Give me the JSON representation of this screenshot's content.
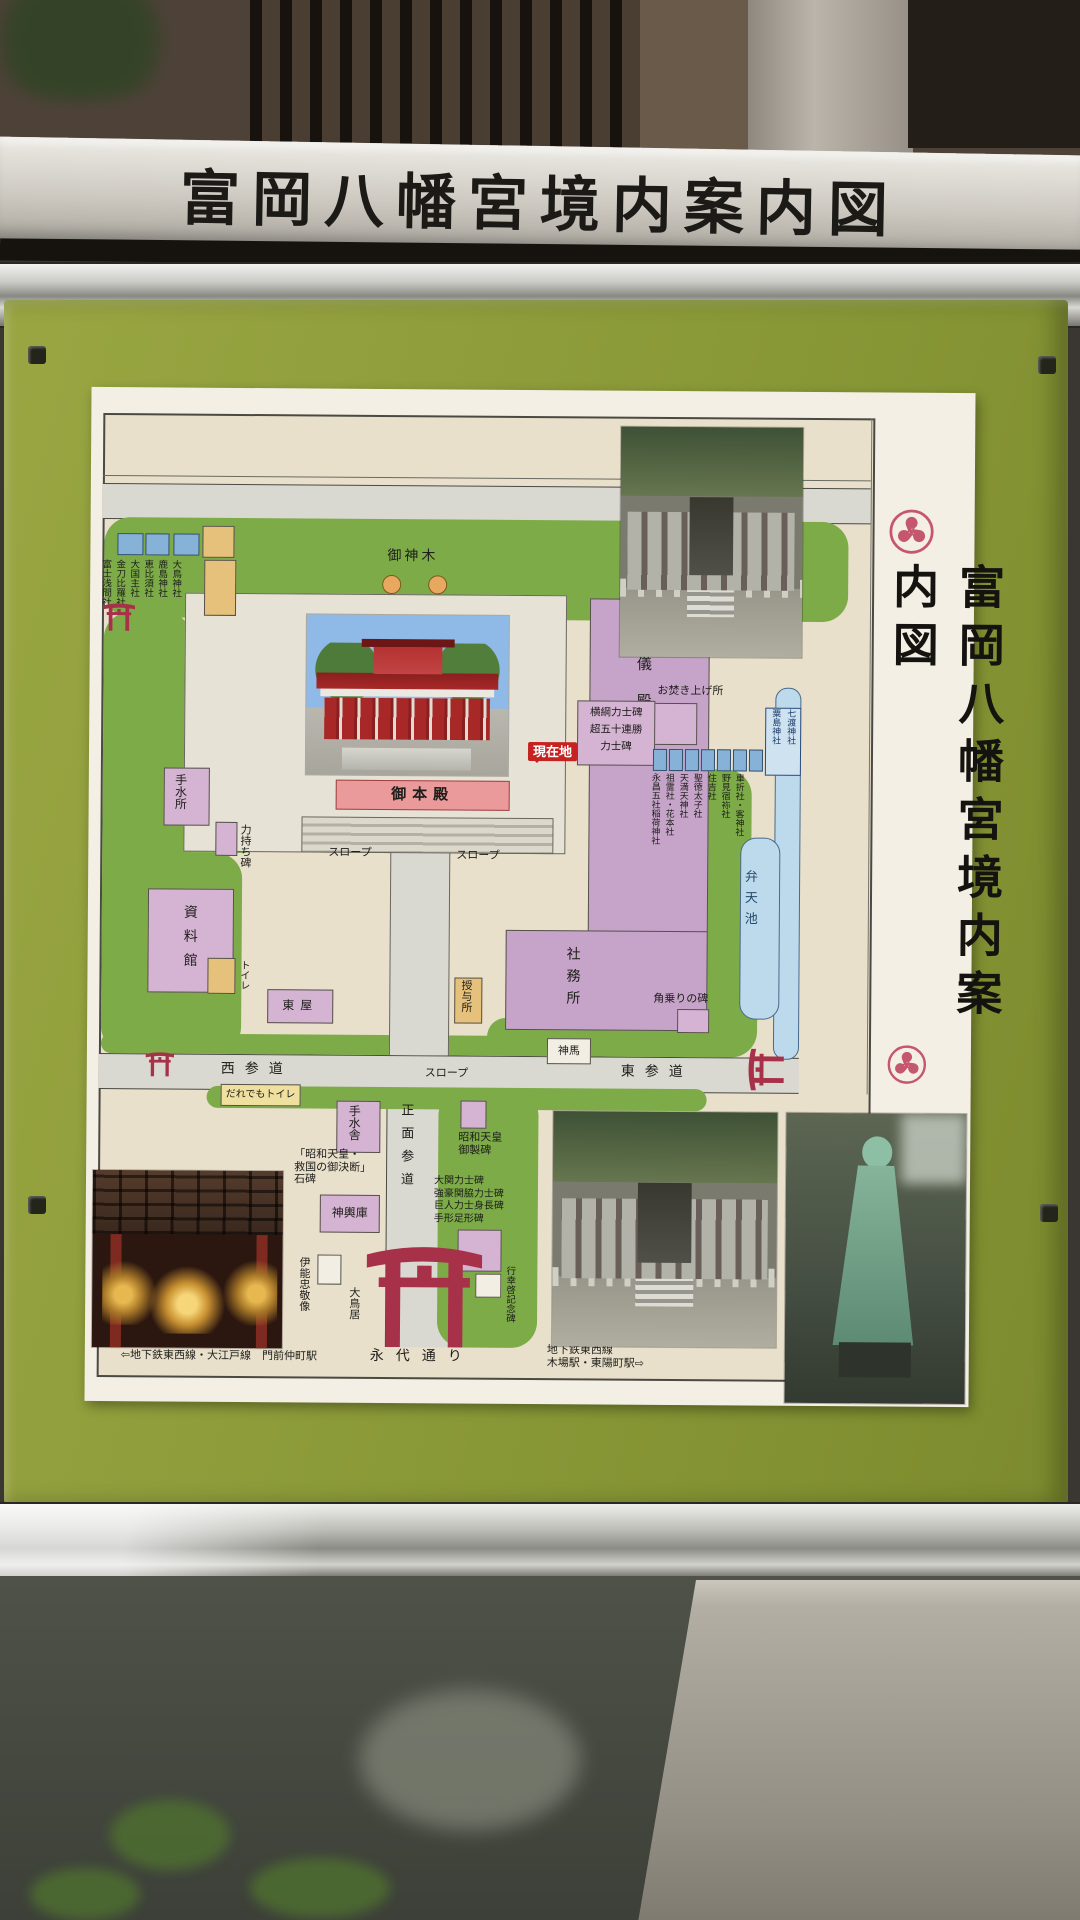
{
  "sign": {
    "header_title": "富岡八幡宮境内案内図",
    "side_title": "富岡八幡宮境内案内図"
  },
  "map": {
    "labels": {
      "goshinboku": "御神木",
      "gohonden": "御本殿",
      "genzaichi": "現在地",
      "slope": "スロープ",
      "chozusho": "手水所",
      "chikaramochi": "力持ち碑",
      "shiryokan": "資料館",
      "toilet": "トイレ",
      "azumaya": "東屋",
      "kongiden": "婚儀殿",
      "shamusho": "社務所",
      "juyosho": "授与所",
      "shinme": "神馬",
      "kakunori": "角乗りの碑",
      "nishi_sando": "西参道",
      "higashi_sando": "東参道",
      "daredemo_toilet": "だれでもトイレ",
      "chozusha": "手水舎",
      "mikoshiko": "神輿庫",
      "ino_tadataka": "伊能忠敬像",
      "shomen_sando": "正面参道",
      "gyokokei": "行幸啓記念碑",
      "otorii": "大鳥居",
      "eitai_dori": "永代通り",
      "otakiage": "お焚き上げ所",
      "bentenike": "弁天池",
      "nanawatari": "七渡神社",
      "awashima": "粟島神社"
    },
    "sekihi_lines": [
      "「昭和天皇・",
      "救国の御決断」",
      "石碑"
    ],
    "gyosei_lines": [
      "昭和天皇",
      "御製碑"
    ],
    "monument_lines": [
      "大関力士碑",
      "強豪関脇力士碑",
      "巨人力士身長碑",
      "手形足形碑"
    ],
    "yokozuna_lines": [
      "横綱力士碑",
      "超五十連勝",
      "力士碑"
    ],
    "small_shrines": [
      "車折社・客神社",
      "野見宿袮社",
      "住吉社",
      "聖徳太子社",
      "天満天神社",
      "祖霊社・花本社",
      "永昌五社稲荷神社"
    ],
    "left_shrines": [
      "大鳥神社",
      "鹿島神社",
      "恵比須社",
      "大国主社",
      "金刀比羅社",
      "富士浅間社"
    ],
    "stations": {
      "left": "⇦地下鉄東西線・大江戸線　門前仲町駅",
      "right1": "地下鉄東西線",
      "right2": "木場駅・東陽町駅⇨"
    }
  },
  "colors": {
    "panel_green": "#8b9a38",
    "map_green": "#7cab48",
    "torii_red": "#a63148",
    "badge_red": "#c52222",
    "building_pink": "#d5b3d3",
    "pond_blue": "#bdd9ec"
  }
}
